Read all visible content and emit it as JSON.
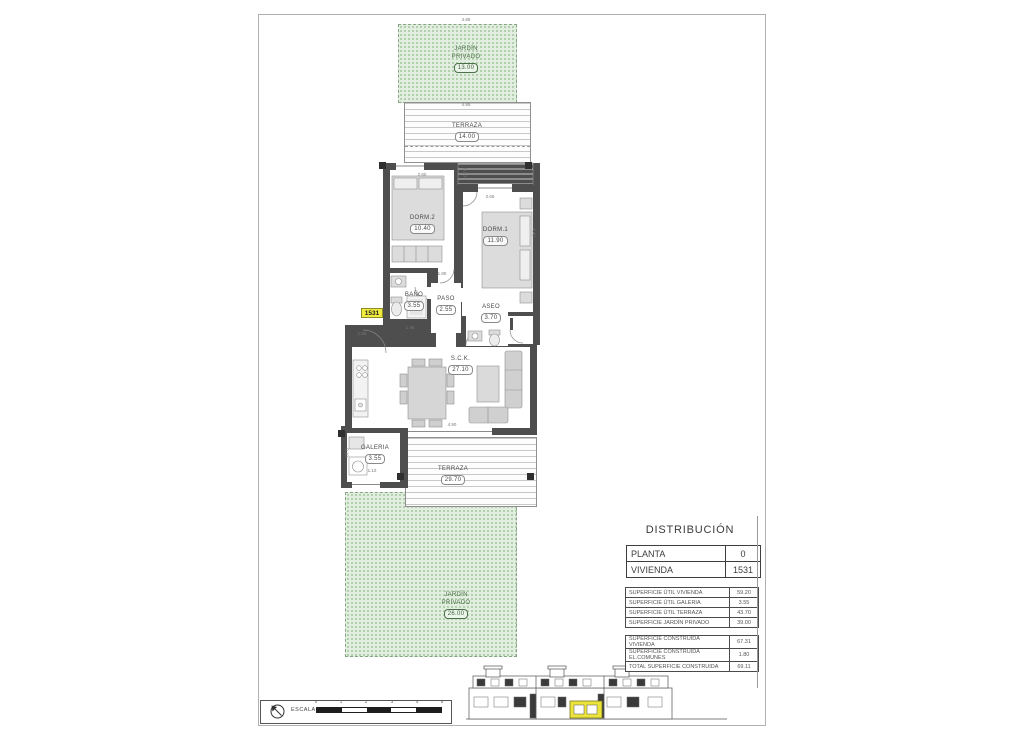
{
  "sheet": {
    "title_block": {
      "title": "DISTRIBUCIÓN",
      "info_rows": [
        {
          "label": "PLANTA",
          "value": "0"
        },
        {
          "label": "VIVIENDA",
          "value": "1531"
        }
      ],
      "util_rows": [
        {
          "label": "SUPERFICIE ÚTIL VIVIENDA",
          "value": "59.20"
        },
        {
          "label": "SUPERFICIE ÚTIL GALERIA",
          "value": "3.55"
        },
        {
          "label": "SUPERFICIE ÚTIL TERRAZA",
          "value": "43.70"
        },
        {
          "label": "SUPERFICIE JARDÍN PRIVADO",
          "value": "39.00"
        }
      ],
      "built_rows": [
        {
          "label": "SUPERFICIE CONSTRUIDA VIVIENDA",
          "value": "67.31"
        },
        {
          "label": "SUPERFICIE CONSTRUIDA EL.COMUNES",
          "value": "1.80"
        },
        {
          "label": "TOTAL SUPERFICIE CONSTRUIDA",
          "value": "69.11"
        }
      ]
    },
    "plan": {
      "unit_tag": "1531",
      "rooms": {
        "garden_top": {
          "name": "JARDÍN\nPRIVADO",
          "area": "13.00"
        },
        "terraza_top": {
          "name": "TERRAZA",
          "area": "14.00"
        },
        "dorm2": {
          "name": "DORM.2",
          "area": "10.40"
        },
        "dorm1": {
          "name": "DORM.1",
          "area": "11.90"
        },
        "bano": {
          "name": "BAÑO",
          "area": "3.55"
        },
        "paso": {
          "name": "PASO",
          "area": "2.55"
        },
        "aseo": {
          "name": "ASEO",
          "area": "3.70"
        },
        "sck": {
          "name": "S.C.K.",
          "area": "27.10"
        },
        "galeria": {
          "name": "GALERIA",
          "area": "3.55"
        },
        "terraza_bottom": {
          "name": "TERRAZA",
          "area": "29.70"
        },
        "garden_bottom": {
          "name": "JARDÍN\nPRIVADO",
          "area": "26.00"
        }
      },
      "dimensions": [
        "4.85",
        "2.60",
        "0.80",
        "2.65",
        "4.40",
        "1.80",
        "1.45",
        "1.05",
        "4.90",
        "1.10",
        "0.10",
        "4.85"
      ]
    },
    "scale_bar": {
      "label": "ESCALA :",
      "ticks": [
        "0",
        "1",
        "2",
        "3",
        "4",
        "5"
      ]
    },
    "colors": {
      "accent_yellow": "#f1eb3d",
      "garden_green": "#e2eedf",
      "wall_gray": "#4e4e4e"
    }
  }
}
